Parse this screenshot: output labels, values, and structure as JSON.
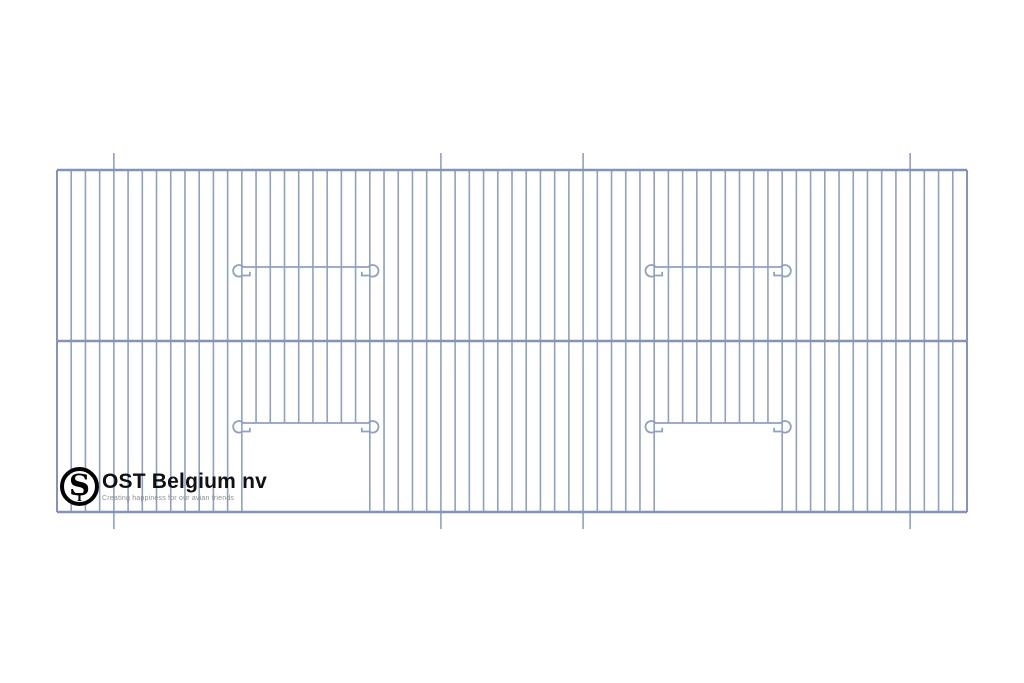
{
  "page": {
    "background": "#ffffff"
  },
  "brand": {
    "name": "OST Belgium nv",
    "tagline": "Creating happiness for our avian friends",
    "monogram_main": "S",
    "monogram_small": "T",
    "name_color": "#111111",
    "tagline_color": "#8f8f8f",
    "ring_color": "#000000"
  },
  "drawing": {
    "description": "Technical line drawing of a wire cage front panel with two door openings and hooked latch wires",
    "wire_color": "#90A0C2",
    "rail_color": "#8593B9",
    "bar_width": 1.6,
    "edge_width": 2,
    "rail_width": 2.4,
    "wire_stroke_width": 1.8,
    "panel": {
      "left": 57,
      "right": 967,
      "top": 170,
      "bottom": 512,
      "mid_rail_y": 341
    },
    "bar_count": 65,
    "long_bar_indices": [
      4,
      27,
      37,
      60
    ],
    "long_bar_overhang": 17,
    "doors": [
      {
        "left_bar": 13,
        "right_bar": 22,
        "top_y": 423
      },
      {
        "left_bar": 42,
        "right_bar": 51,
        "top_y": 423
      }
    ],
    "hook_wires": [
      {
        "left_bar": 13,
        "right_bar": 22,
        "y": 267
      },
      {
        "left_bar": 42,
        "right_bar": 51,
        "y": 267
      },
      {
        "left_bar": 13,
        "right_bar": 22,
        "y": 423
      },
      {
        "left_bar": 42,
        "right_bar": 51,
        "y": 423
      }
    ],
    "hook_overhang": 9,
    "hook_radius": 5.8
  }
}
